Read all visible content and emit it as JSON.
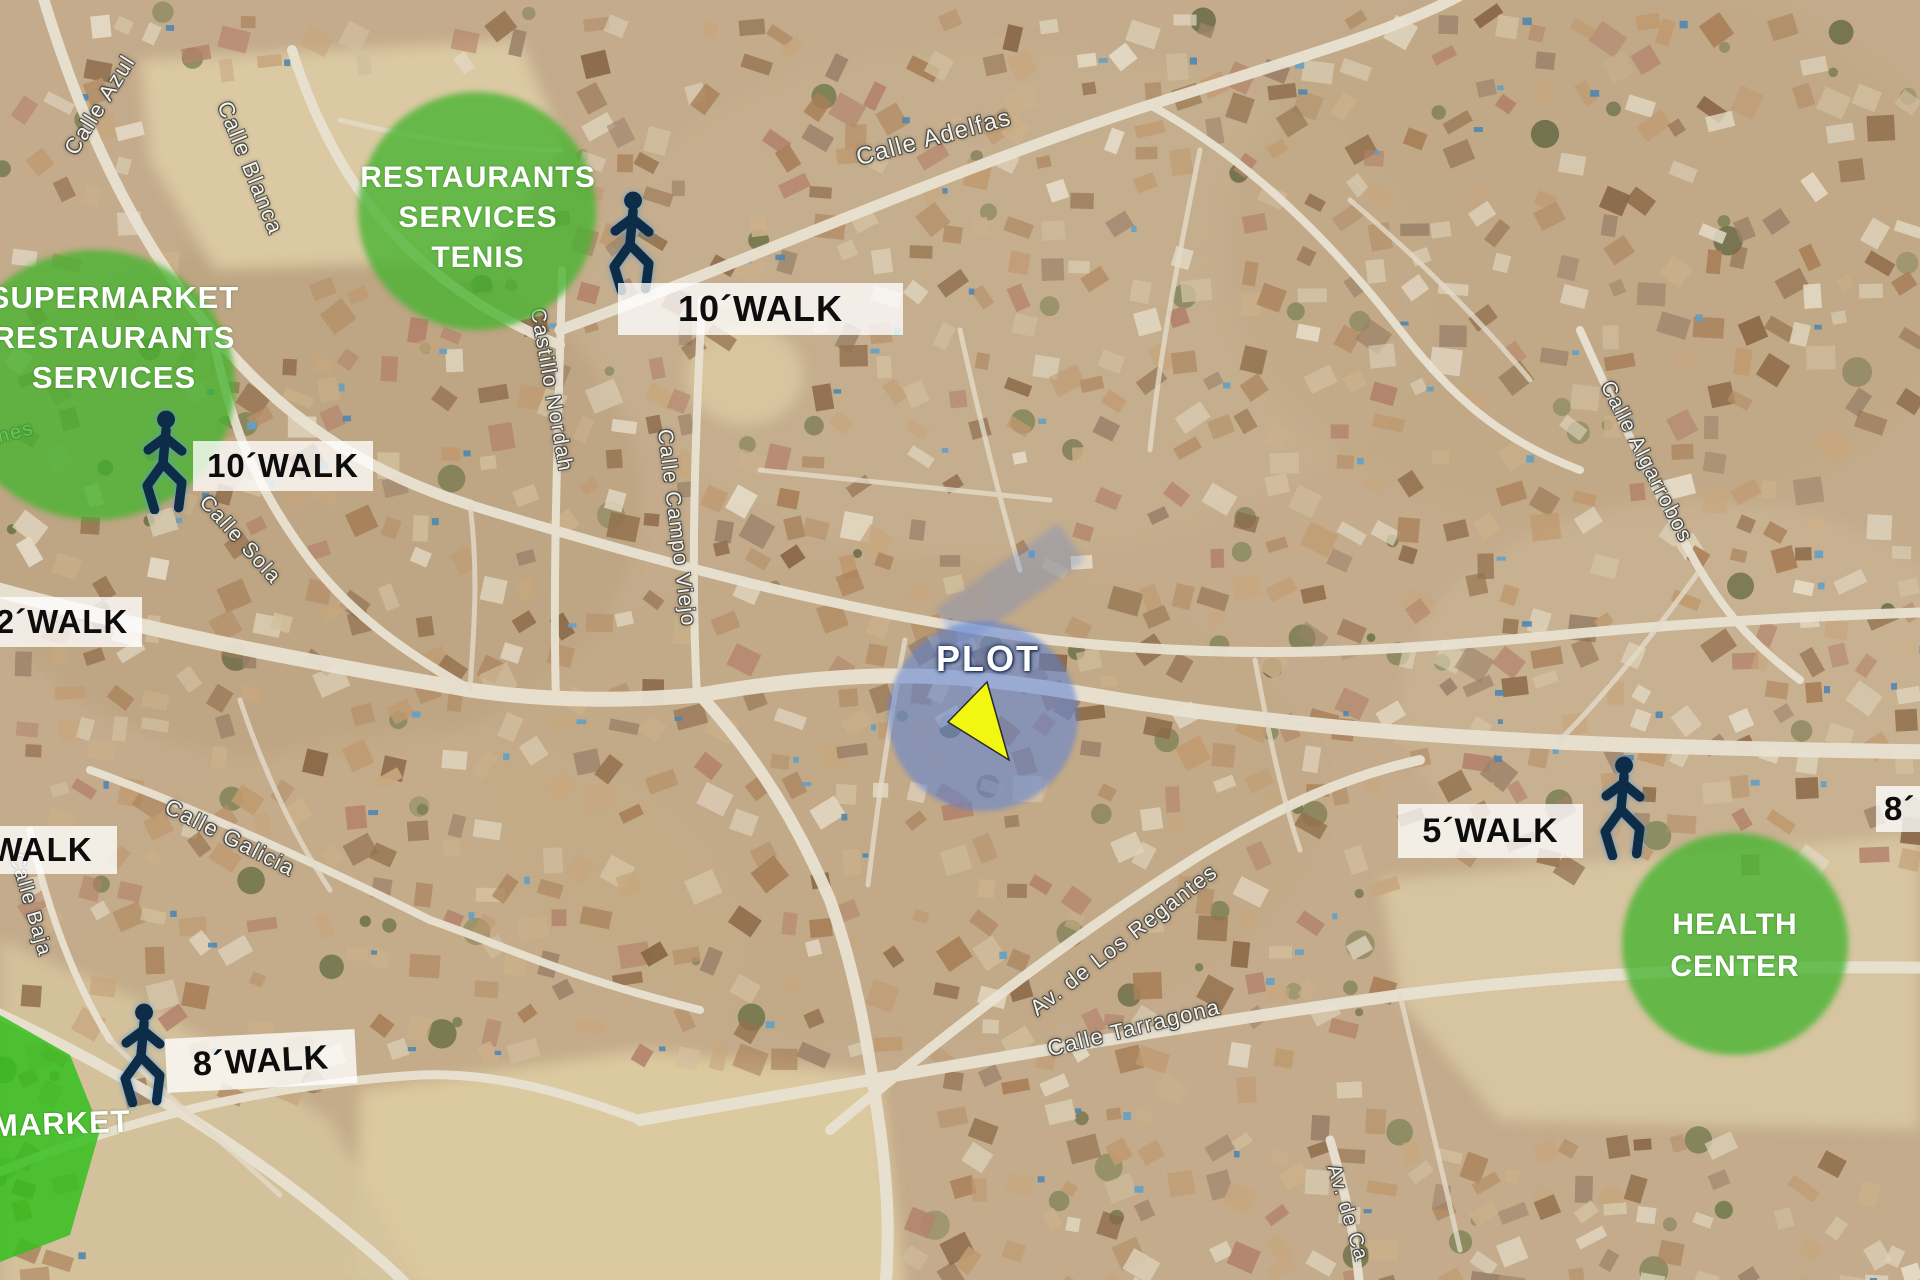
{
  "colors": {
    "zone-green": "#46b430",
    "market-green": "#35bf1e",
    "plot-blue": "#5b82d8",
    "arrow-yellow": "#f2f712",
    "walker-navy": "#0d2c47"
  },
  "zones": {
    "supermarket": {
      "lines": [
        "SUPERMARKET",
        "RESTAURANTS",
        "SERVICES"
      ]
    },
    "restaurants": {
      "lines": [
        "RESTAURANTS",
        "SERVICES",
        "TENIS"
      ]
    },
    "health": {
      "lines": [
        "HEALTH",
        "CENTER"
      ]
    },
    "market_label": "MARKET"
  },
  "badges": {
    "top": "10´WALK",
    "left": "10´WALK",
    "left_edge_upper": "2´WALK",
    "left_edge_lower": "´WALK",
    "bottom_left": "8´WALK",
    "right": "5´WALK",
    "right_edge": "8´"
  },
  "plot": {
    "label": "PLOT"
  },
  "streets": [
    {
      "text": "Calle Azul"
    },
    {
      "text": "Calle Blanca"
    },
    {
      "text": "Calle Adelfas"
    },
    {
      "text": "Castillo Nordah"
    },
    {
      "text": "Calle Campo Viejo"
    },
    {
      "text": "Calle Sola"
    },
    {
      "text": "Calle Galicia"
    },
    {
      "text": "Calle Baja"
    },
    {
      "text": "nes"
    },
    {
      "text": "Av. de Los Regantes"
    },
    {
      "text": "Calle Tarragona"
    },
    {
      "text": "Calle Algarrobos"
    },
    {
      "text": "Av. de Ca"
    }
  ]
}
